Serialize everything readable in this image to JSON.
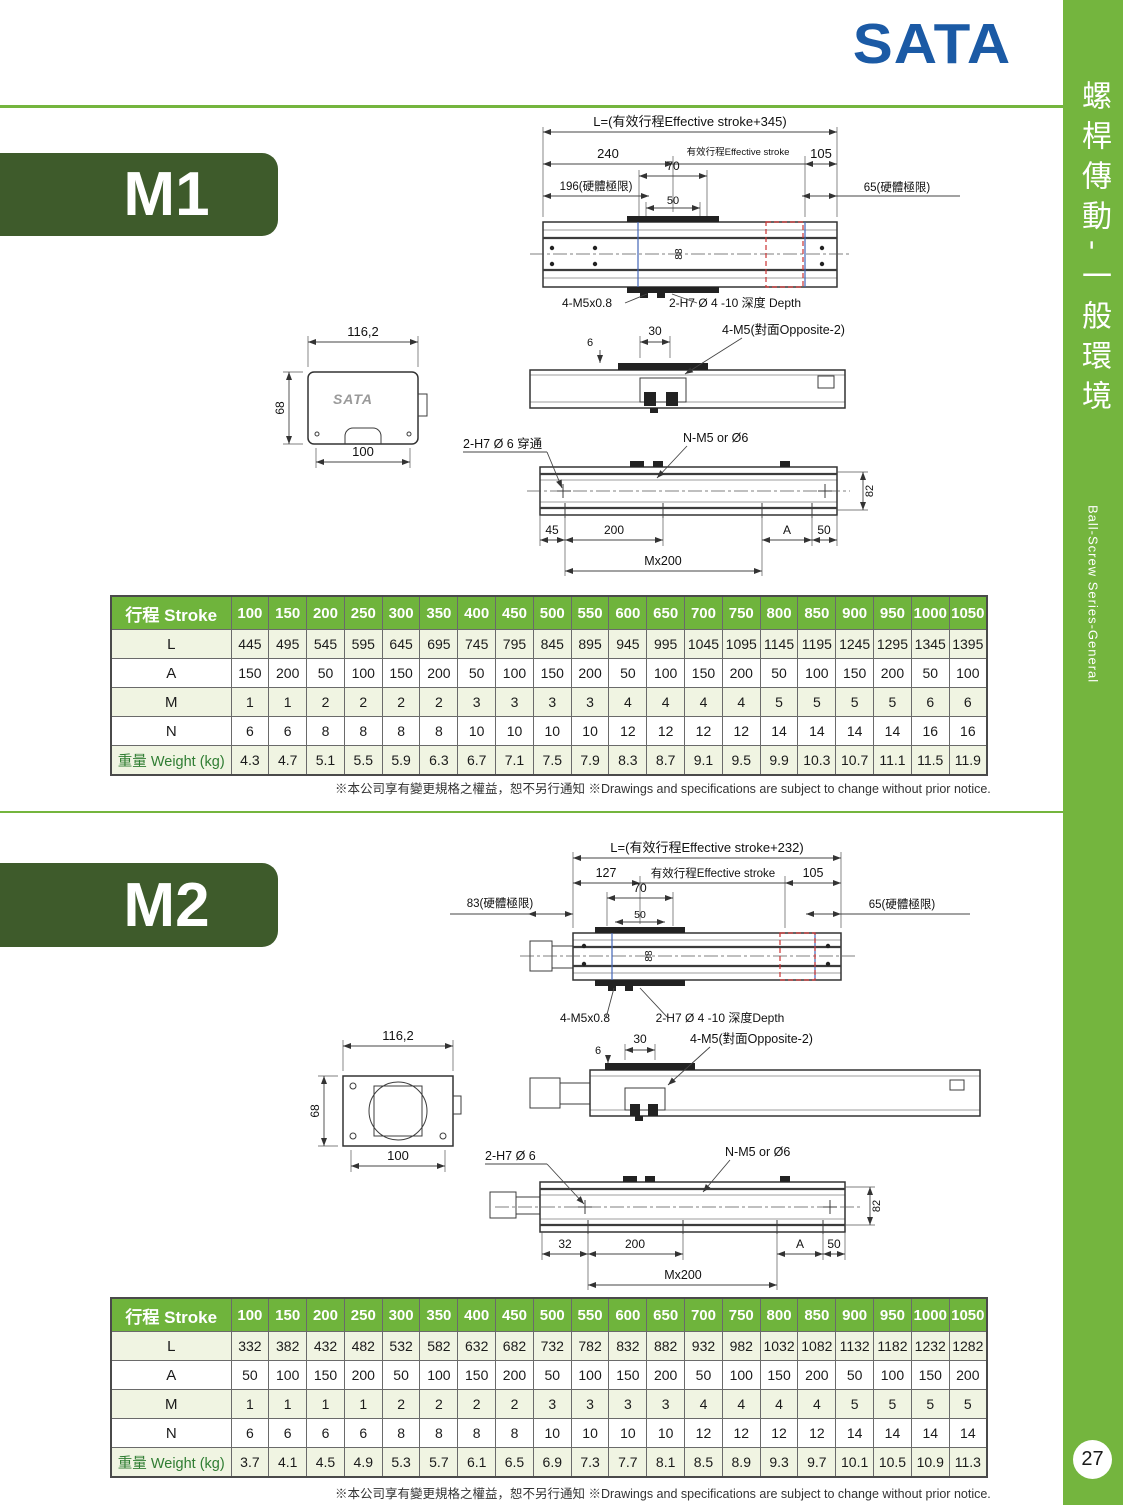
{
  "colors": {
    "accent_green": "#74b53e",
    "badge_green": "#3e5b2b",
    "header_green": "#6fb43c",
    "row_tint": "#f0f4e2",
    "logo_blue": "#1b5aa5",
    "red_dashed": "#cc3333",
    "blue_line": "#4466b8"
  },
  "logo": {
    "text": "SATA"
  },
  "sidebar": {
    "title_zh": "螺桿傳動-一般環境",
    "title_en": "Ball-Screw Series-General",
    "page_number": "27"
  },
  "footnote": "※本公司享有變更規格之權益，恕不另行通知 ※Drawings and specifications are subject to change without prior notice.",
  "m1": {
    "label": "M1",
    "front": {
      "dim_L": "L=(有效行程Effective stroke+345)",
      "dim_240": "240",
      "dim_es": "有效行程Effective stroke",
      "dim_105": "105",
      "dim_196": "196(硬體極限)",
      "dim_70": "70",
      "dim_50": "50",
      "dim_65": "65(硬體極限)",
      "dim_88": "88",
      "label_m5": "4-M5x0.8",
      "label_h7": "2-H7 Ø 4 -10 深度 Depth"
    },
    "end": {
      "dim_width": "116,2",
      "dim_height": "68",
      "dim_base": "100",
      "logo": "SATA"
    },
    "side": {
      "dim_6": "6",
      "dim_30": "30",
      "label_m5": "4-M5(對面Opposite-2)"
    },
    "bottom": {
      "label_h7": "2-H7 Ø 6 穿通",
      "label_nm5": "N-M5 or Ø6",
      "dim_45": "45",
      "dim_200": "200",
      "dim_A": "A",
      "dim_50": "50",
      "dim_mx": "Mx200",
      "dim_82": "82"
    },
    "table": {
      "header_label": "行程 Stroke",
      "header_values": [
        "100",
        "150",
        "200",
        "250",
        "300",
        "350",
        "400",
        "450",
        "500",
        "550",
        "600",
        "650",
        "700",
        "750",
        "800",
        "850",
        "900",
        "950",
        "1000",
        "1050"
      ],
      "rows": [
        {
          "label": "L",
          "values": [
            "445",
            "495",
            "545",
            "595",
            "645",
            "695",
            "745",
            "795",
            "845",
            "895",
            "945",
            "995",
            "1045",
            "1095",
            "1145",
            "1195",
            "1245",
            "1295",
            "1345",
            "1395"
          ]
        },
        {
          "label": "A",
          "values": [
            "150",
            "200",
            "50",
            "100",
            "150",
            "200",
            "50",
            "100",
            "150",
            "200",
            "50",
            "100",
            "150",
            "200",
            "50",
            "100",
            "150",
            "200",
            "50",
            "100"
          ]
        },
        {
          "label": "M",
          "values": [
            "1",
            "1",
            "2",
            "2",
            "2",
            "2",
            "3",
            "3",
            "3",
            "3",
            "4",
            "4",
            "4",
            "4",
            "5",
            "5",
            "5",
            "5",
            "6",
            "6"
          ]
        },
        {
          "label": "N",
          "values": [
            "6",
            "6",
            "8",
            "8",
            "8",
            "8",
            "10",
            "10",
            "10",
            "10",
            "12",
            "12",
            "12",
            "12",
            "14",
            "14",
            "14",
            "14",
            "16",
            "16"
          ]
        },
        {
          "label": "重量 Weight (kg)",
          "values": [
            "4.3",
            "4.7",
            "5.1",
            "5.5",
            "5.9",
            "6.3",
            "6.7",
            "7.1",
            "7.5",
            "7.9",
            "8.3",
            "8.7",
            "9.1",
            "9.5",
            "9.9",
            "10.3",
            "10.7",
            "11.1",
            "11.5",
            "11.9"
          ]
        }
      ]
    }
  },
  "m2": {
    "label": "M2",
    "front": {
      "dim_L": "L=(有效行程Effective stroke+232)",
      "dim_127": "127",
      "dim_es": "有效行程Effective stroke",
      "dim_105": "105",
      "dim_83": "83(硬體極限)",
      "dim_70": "70",
      "dim_50": "50",
      "dim_65": "65(硬體極限)",
      "dim_88": "88",
      "label_m5": "4-M5x0.8",
      "label_h7": "2-H7 Ø 4 -10 深度Depth"
    },
    "end": {
      "dim_width": "116,2",
      "dim_height": "68",
      "dim_base": "100"
    },
    "side": {
      "dim_6": "6",
      "dim_30": "30",
      "label_m5": "4-M5(對面Opposite-2)"
    },
    "bottom": {
      "label_h7": "2-H7 Ø 6",
      "label_nm5": "N-M5 or Ø6",
      "dim_32": "32",
      "dim_200": "200",
      "dim_A": "A",
      "dim_50": "50",
      "dim_mx": "Mx200",
      "dim_82": "82"
    },
    "table": {
      "header_label": "行程 Stroke",
      "header_values": [
        "100",
        "150",
        "200",
        "250",
        "300",
        "350",
        "400",
        "450",
        "500",
        "550",
        "600",
        "650",
        "700",
        "750",
        "800",
        "850",
        "900",
        "950",
        "1000",
        "1050"
      ],
      "rows": [
        {
          "label": "L",
          "values": [
            "332",
            "382",
            "432",
            "482",
            "532",
            "582",
            "632",
            "682",
            "732",
            "782",
            "832",
            "882",
            "932",
            "982",
            "1032",
            "1082",
            "1132",
            "1182",
            "1232",
            "1282"
          ]
        },
        {
          "label": "A",
          "values": [
            "50",
            "100",
            "150",
            "200",
            "50",
            "100",
            "150",
            "200",
            "50",
            "100",
            "150",
            "200",
            "50",
            "100",
            "150",
            "200",
            "50",
            "100",
            "150",
            "200"
          ]
        },
        {
          "label": "M",
          "values": [
            "1",
            "1",
            "1",
            "1",
            "2",
            "2",
            "2",
            "2",
            "3",
            "3",
            "3",
            "3",
            "4",
            "4",
            "4",
            "4",
            "5",
            "5",
            "5",
            "5"
          ]
        },
        {
          "label": "N",
          "values": [
            "6",
            "6",
            "6",
            "6",
            "8",
            "8",
            "8",
            "8",
            "10",
            "10",
            "10",
            "10",
            "12",
            "12",
            "12",
            "12",
            "14",
            "14",
            "14",
            "14"
          ]
        },
        {
          "label": "重量 Weight (kg)",
          "values": [
            "3.7",
            "4.1",
            "4.5",
            "4.9",
            "5.3",
            "5.7",
            "6.1",
            "6.5",
            "6.9",
            "7.3",
            "7.7",
            "8.1",
            "8.5",
            "8.9",
            "9.3",
            "9.7",
            "10.1",
            "10.5",
            "10.9",
            "11.3"
          ]
        }
      ]
    }
  }
}
